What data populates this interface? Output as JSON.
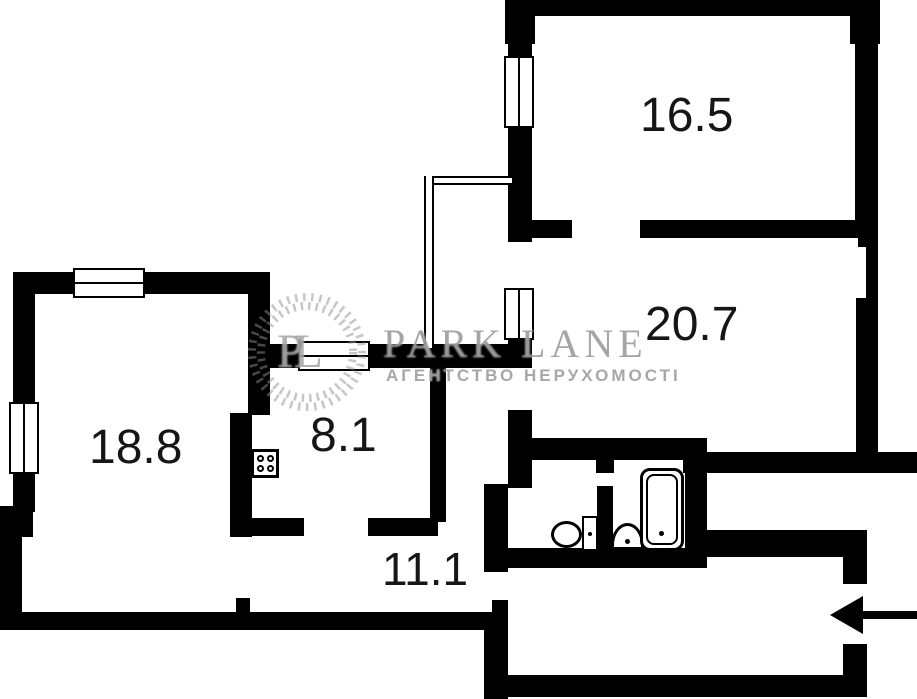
{
  "plan": {
    "background_color": "#ffffff",
    "wall_color": "#000000",
    "rooms": [
      {
        "id": "living-room-top-right",
        "area_label": "16.5"
      },
      {
        "id": "living-room-right",
        "area_label": "20.7"
      },
      {
        "id": "living-room-left",
        "area_label": "18.8"
      },
      {
        "id": "kitchen",
        "area_label": "8.1"
      },
      {
        "id": "hallway",
        "area_label": "11.1"
      }
    ],
    "fixtures": [
      {
        "id": "stove",
        "icon": "stove-icon"
      },
      {
        "id": "toilet",
        "icon": "toilet-icon"
      },
      {
        "id": "sink",
        "icon": "sink-icon"
      },
      {
        "id": "bathtub",
        "icon": "bathtub-icon"
      }
    ],
    "entrance": {
      "icon": "entrance-arrow-icon",
      "direction": "left"
    }
  },
  "watermark": {
    "monogram": "PL",
    "brand": "PARK LANE",
    "tagline": "АГЕНТСТВО НЕРУХОМОСТІ",
    "color": "#8f8f8f"
  }
}
